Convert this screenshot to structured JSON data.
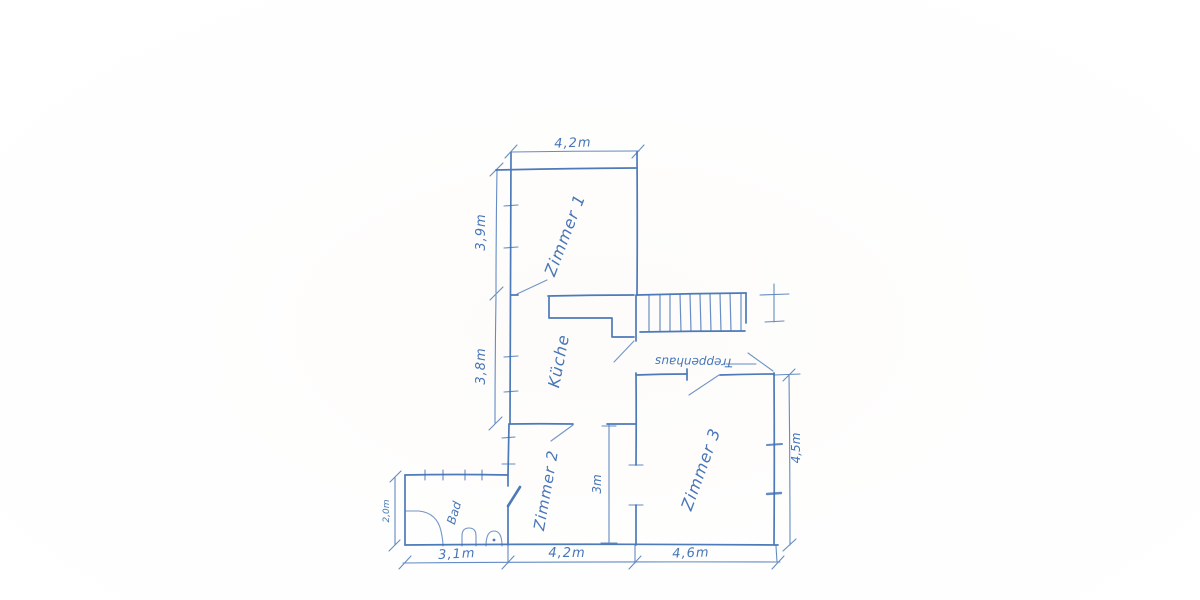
{
  "sketch": {
    "ink_color": "#3e6fb4",
    "paper_color": "#fdfcfa",
    "rooms": {
      "zimmer1": {
        "label": "Zimmer 1"
      },
      "kueche": {
        "label": "Küche"
      },
      "treppenhaus": {
        "label": "Treppenhaus"
      },
      "zimmer2": {
        "label": "Zimmer 2"
      },
      "zimmer3": {
        "label": "Zimmer 3"
      },
      "bad": {
        "label": "Bad"
      }
    },
    "dimensions": {
      "top_width": "4,2m",
      "zimmer1_height": "3,9m",
      "kueche_height": "3,8m",
      "bad_height": "2,0m",
      "bottom_bad_width": "3,1m",
      "bottom_zimmer2_width": "4,2m",
      "bottom_zimmer3_width": "4,6m",
      "right_height": "4,5m",
      "zimmer2_inner_height": "3m"
    }
  }
}
